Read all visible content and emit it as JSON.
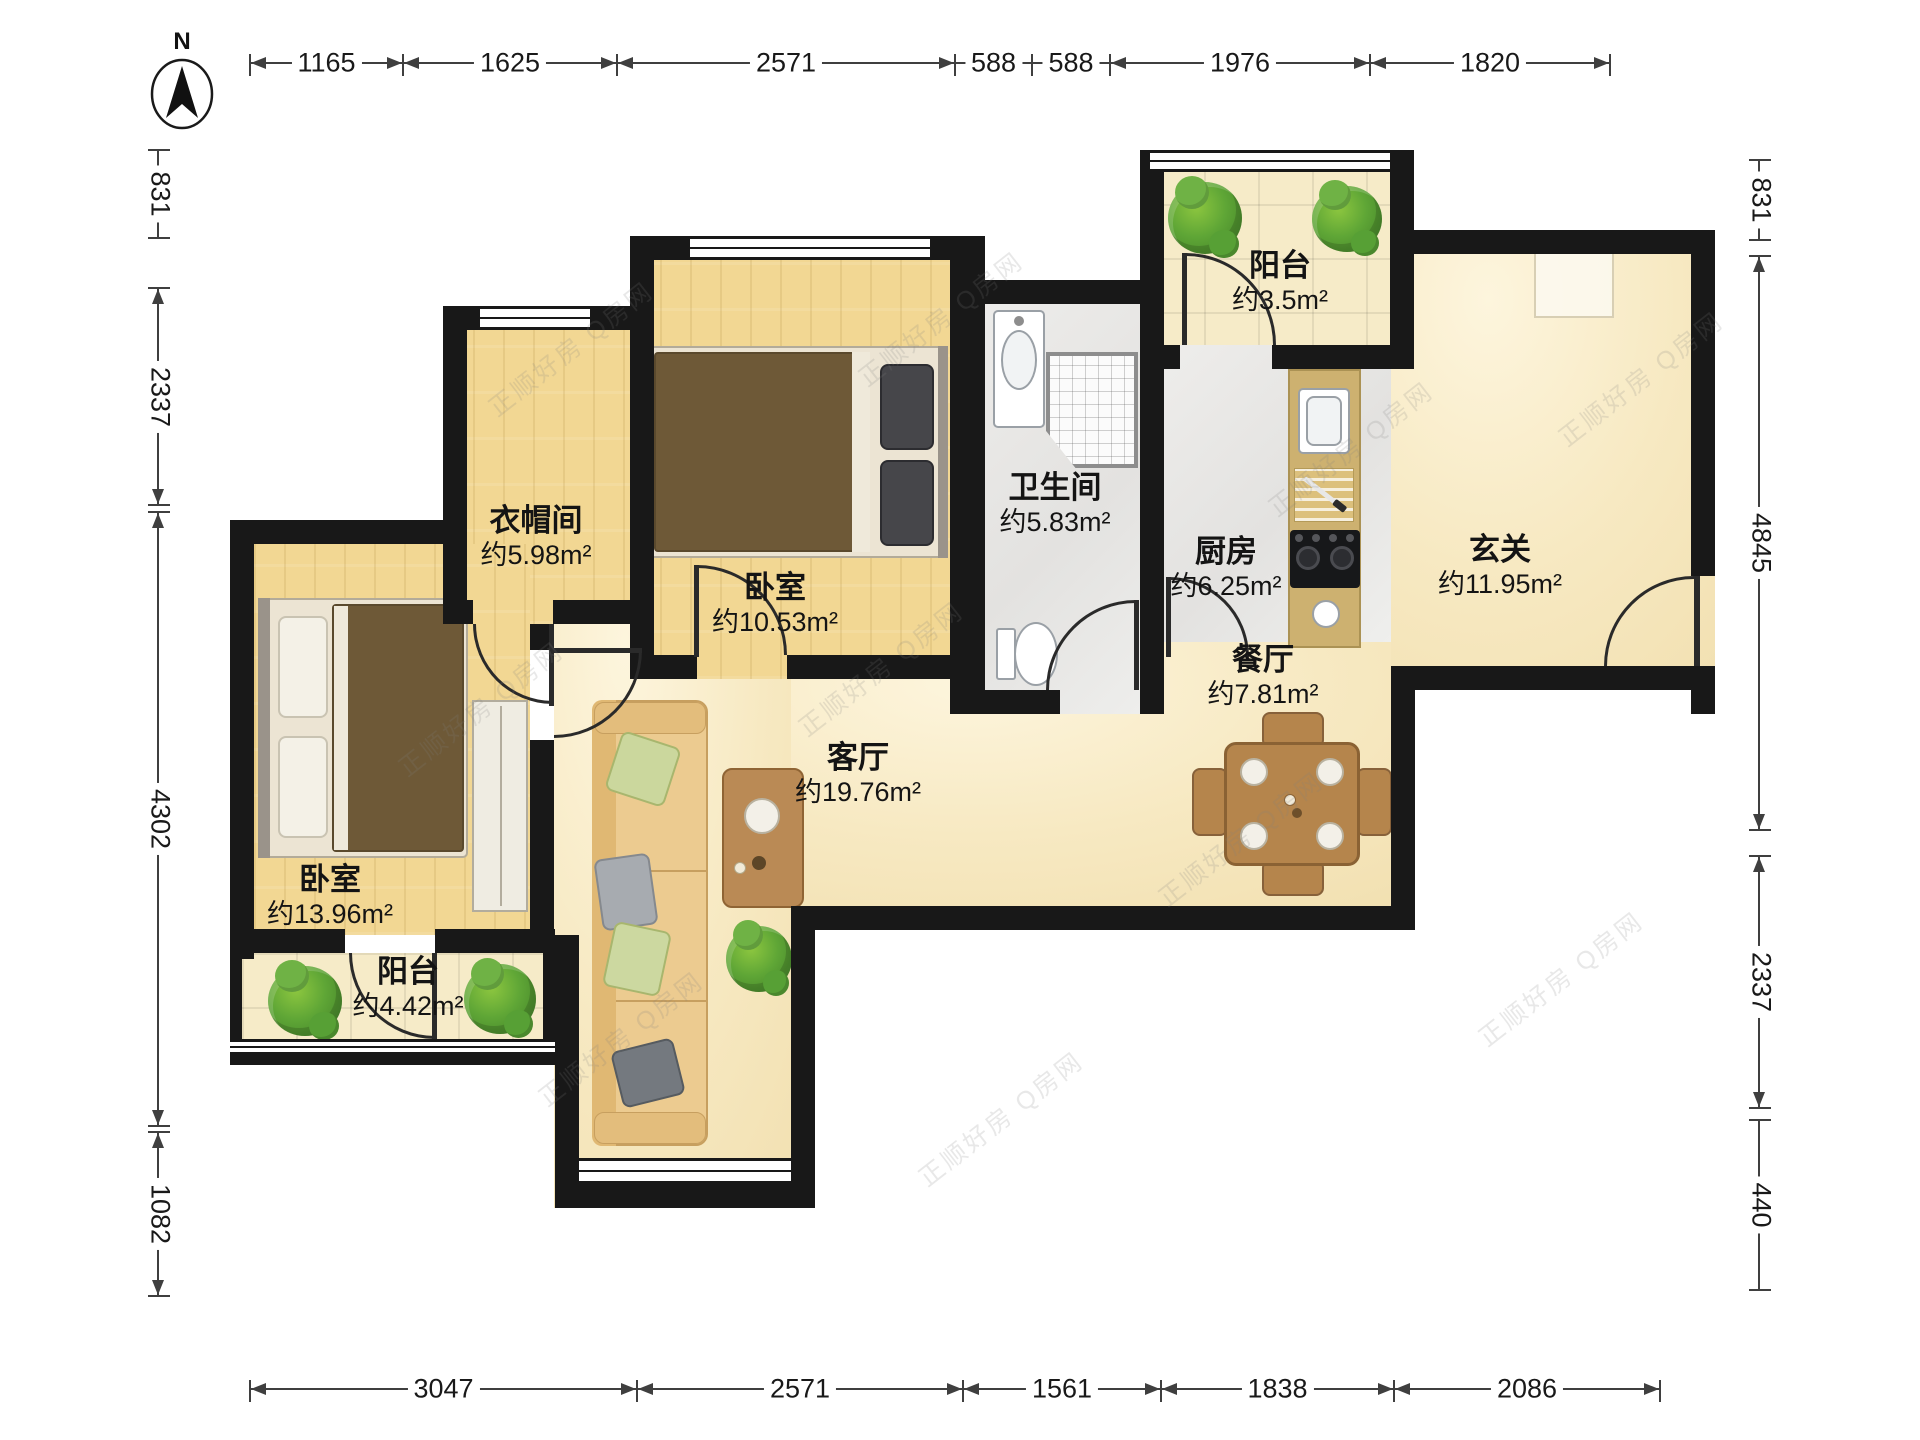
{
  "compass": {
    "label": "N"
  },
  "watermark": {
    "text": "正顺好房 Q房网"
  },
  "dimensions": {
    "top": [
      "1165",
      "1625",
      "2571",
      "588",
      "588",
      "1976",
      "1820"
    ],
    "bottom": [
      "3047",
      "2571",
      "1561",
      "1838",
      "2086"
    ],
    "left": [
      "831",
      "2337",
      "4302",
      "1082"
    ],
    "right": [
      "831",
      "4845",
      "2337",
      "440"
    ]
  },
  "rooms": {
    "cloakroom": {
      "name": "衣帽间",
      "area": "约5.98m²"
    },
    "bedroom_top": {
      "name": "卧室",
      "area": "约10.53m²"
    },
    "bathroom": {
      "name": "卫生间",
      "area": "约5.83m²"
    },
    "kitchen": {
      "name": "厨房",
      "area": "约6.25m²"
    },
    "hallway": {
      "name": "玄关",
      "area": "约11.95m²"
    },
    "balcony_top": {
      "name": "阳台",
      "area": "约3.5m²"
    },
    "living": {
      "name": "客厅",
      "area": "约19.76m²"
    },
    "dining": {
      "name": "餐厅",
      "area": "约7.81m²"
    },
    "bedroom_bottom": {
      "name": "卧室",
      "area": "约13.96m²"
    },
    "balcony_bottom": {
      "name": "阳台",
      "area": "约4.42m²"
    }
  },
  "colors": {
    "wall": "#181818",
    "wood_floor": "#f2d793",
    "warm_marble": "#f7e9c2",
    "grey_marble": "#e9e8e6",
    "tile": "#f6ebc8",
    "furniture_wood": "#b5854c",
    "duvet": "#6e5937",
    "plant": "#5fa636"
  }
}
